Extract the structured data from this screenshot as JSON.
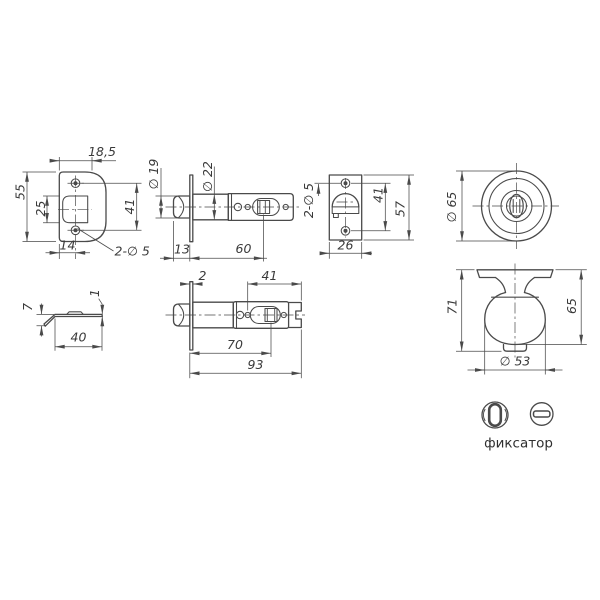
{
  "colors": {
    "background": "#ffffff",
    "line": "#4a4a4a",
    "text": "#3a3a3a"
  },
  "views": {
    "strike_front": {
      "width_top": "18,5",
      "height": "55",
      "opening_height": "25",
      "hole_spacing": "41",
      "width_bottom": "14",
      "holes_note": "2-∅ 5"
    },
    "latch_60": {
      "bolt_dia": "∅ 19",
      "tube_dia": "∅ 22",
      "bolt_projection": "13",
      "backset": "60"
    },
    "faceplate_front": {
      "holes_note": "2-∅ 5",
      "hole_spacing": "41",
      "height": "57",
      "width": "26"
    },
    "rose_front": {
      "diameter": "∅ 65"
    },
    "strike_side": {
      "profile_height": "7",
      "thickness": "1",
      "width": "40"
    },
    "latch_70": {
      "faceplate_thickness": "2",
      "housing_length": "41",
      "backset": "70",
      "total_length": "93"
    },
    "knob_side": {
      "height_total": "71",
      "height_knob": "65",
      "knob_diameter": "∅ 53"
    },
    "legend": {
      "caption": "фиксатор"
    }
  }
}
